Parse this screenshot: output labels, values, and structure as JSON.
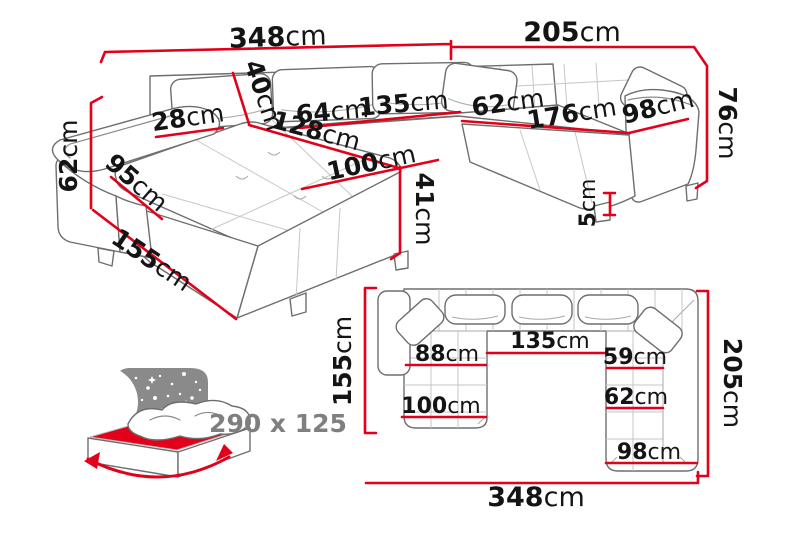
{
  "diagram": "corner-sofa-dimensions",
  "colors": {
    "dimension_red": "#e2001a",
    "sofa_outline_gray": "#6e6e6e",
    "seam_gray": "#c6c6c6",
    "label_black": "#141414",
    "muted_gray": "#7f7f7f",
    "night_panel_gray": "#8a8a8a"
  },
  "perspective_view": {
    "name": "3D dimensioned view of corner sofa",
    "dimensions": {
      "total_width_left": {
        "value": "348",
        "unit": "cm"
      },
      "total_width_right": {
        "value": "205",
        "unit": "cm"
      },
      "height_right": {
        "value": "76",
        "unit": "cm"
      },
      "height_left": {
        "value": "62",
        "unit": "cm"
      },
      "chaise_side_length": {
        "value": "155",
        "unit": "cm"
      },
      "armrest_side": {
        "value": "95",
        "unit": "cm"
      },
      "armrest_width": {
        "value": "28",
        "unit": "cm"
      },
      "backrest_height": {
        "value": "40",
        "unit": "cm"
      },
      "chaise_inner_length": {
        "value": "128",
        "unit": "cm"
      },
      "seat_depth_back": {
        "value": "64",
        "unit": "cm"
      },
      "seat_width_back": {
        "value": "135",
        "unit": "cm"
      },
      "chaise_width": {
        "value": "100",
        "unit": "cm"
      },
      "seat_height": {
        "value": "41",
        "unit": "cm"
      },
      "seat_depth_right": {
        "value": "62",
        "unit": "cm"
      },
      "seat_width_right": {
        "value": "176",
        "unit": "cm"
      },
      "right_arm_section": {
        "value": "98",
        "unit": "cm"
      },
      "leg_height": {
        "value": "5",
        "unit": "cm"
      }
    }
  },
  "plan_view": {
    "name": "Top-down dimensioned view of corner sofa",
    "dimensions": {
      "depth_left": {
        "value": "155",
        "unit": "cm"
      },
      "depth_right": {
        "value": "205",
        "unit": "cm"
      },
      "total_width": {
        "value": "348",
        "unit": "cm"
      },
      "chaise_seat_width": {
        "value": "88",
        "unit": "cm"
      },
      "middle_seat_width": {
        "value": "135",
        "unit": "cm"
      },
      "right_seat_width": {
        "value": "59",
        "unit": "cm"
      },
      "right_seat_depth": {
        "value": "62",
        "unit": "cm"
      },
      "chaise_total_width": {
        "value": "100",
        "unit": "cm"
      },
      "right_section_width": {
        "value": "98",
        "unit": "cm"
      }
    }
  },
  "sleeping_function": {
    "icon": "bed-fold-out-icon",
    "size_label": "290 x 125"
  }
}
